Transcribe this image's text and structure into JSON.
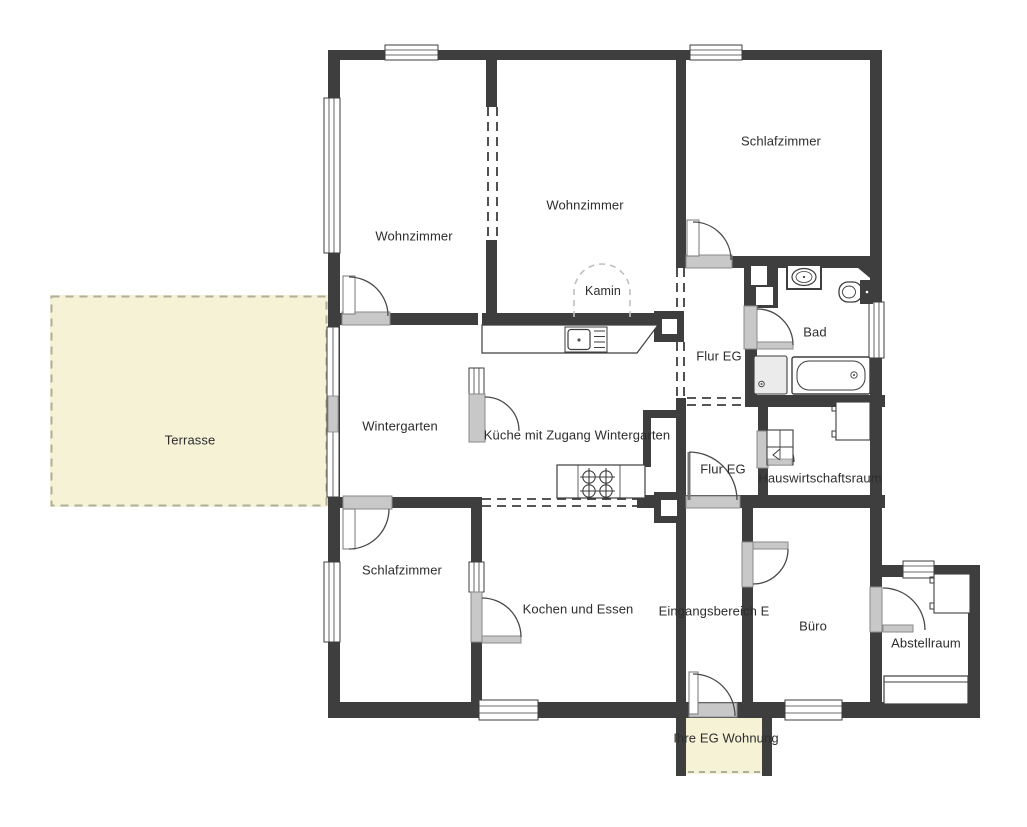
{
  "floorplan": {
    "type": "floor-plan-ground-floor",
    "labels": {
      "terrasse": "Terrasse",
      "wohnzimmer_links": "Wohnzimmer",
      "wohnzimmer_mitte": "Wohnzimmer",
      "schlafzimmer_oben": "Schlafzimmer",
      "kamin": "Kamin",
      "bad": "Bad",
      "flur_eg_oben": "Flur EG",
      "wintergarten": "Wintergarten",
      "kueche": "Küche mit Zugang Wintergarten",
      "flur_eg_unten": "Flur EG",
      "hauswirtschaftsraum": "Hauswirtschaftsraum",
      "schlafzimmer_unten": "Schlafzimmer",
      "kochen_und_essen": "Kochen und Essen",
      "eingangsbereich": "Eingangsbereich E",
      "buero": "Büro",
      "abstellraum": "Abstellraum",
      "ihre_eg_wohnung": "Ihre EG Wohnung"
    },
    "colors": {
      "wall": "#3e3e3e",
      "terrace_fill": "#f5f2d6",
      "entry_fill": "#f5f2d6",
      "door_fill": "#c8c8c8",
      "dash_accent": "#b0ae9c",
      "text": "#2d2d2d"
    }
  }
}
